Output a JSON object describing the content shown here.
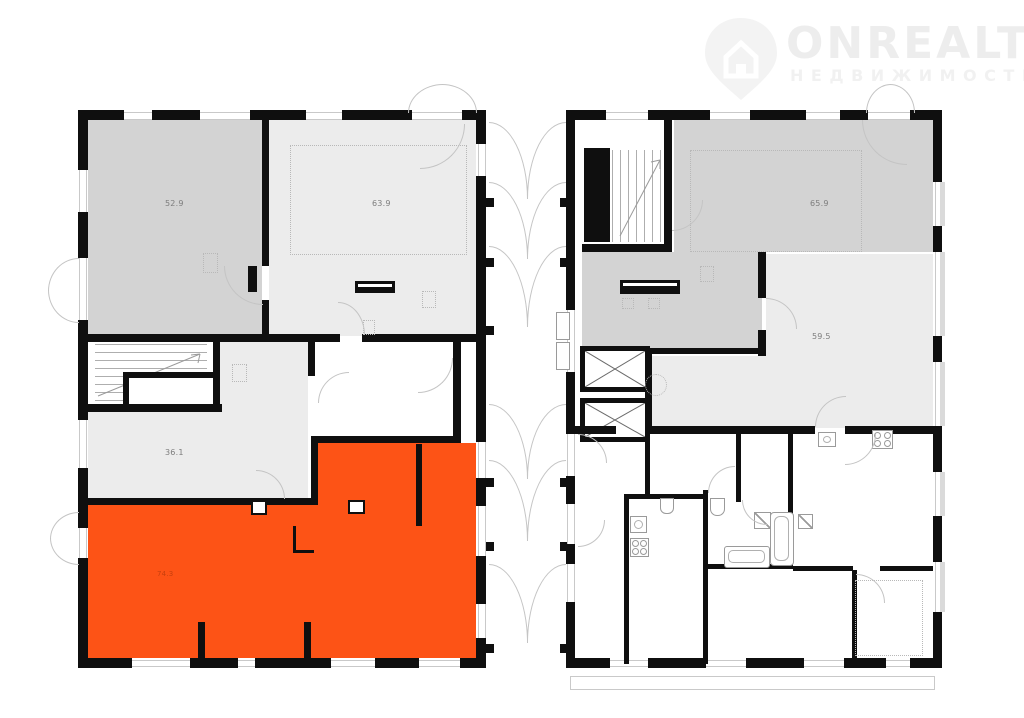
{
  "watermark": {
    "brand": "ONREALT",
    "subtitle": "НЕДВИЖИМОСТЬ",
    "icon": "house-pin-icon"
  },
  "colors": {
    "wall": "#0f0f0f",
    "room_gray": "#d3d3d3",
    "room_light": "#ececec",
    "highlight": "#fd5316",
    "outline_gray": "#c4c4c4",
    "label_gray": "#7d7d7d"
  },
  "floorplan": {
    "type": "residential-floor-plan",
    "left_building": {
      "rooms": [
        {
          "id": "room-52-9",
          "area_label": "52.9",
          "shade": "gray"
        },
        {
          "id": "room-63-9",
          "area_label": "63.9",
          "shade": "light"
        },
        {
          "id": "room-36-1",
          "area_label": "36.1",
          "shade": "light"
        },
        {
          "id": "room-selected",
          "area_label": "74.3",
          "shade": "orange",
          "state": "highlighted"
        }
      ]
    },
    "right_building": {
      "rooms": [
        {
          "id": "room-65-9",
          "area_label": "65.9",
          "shade": "gray"
        },
        {
          "id": "room-59-5",
          "area_label": "59.5",
          "shade": "light"
        }
      ]
    }
  }
}
